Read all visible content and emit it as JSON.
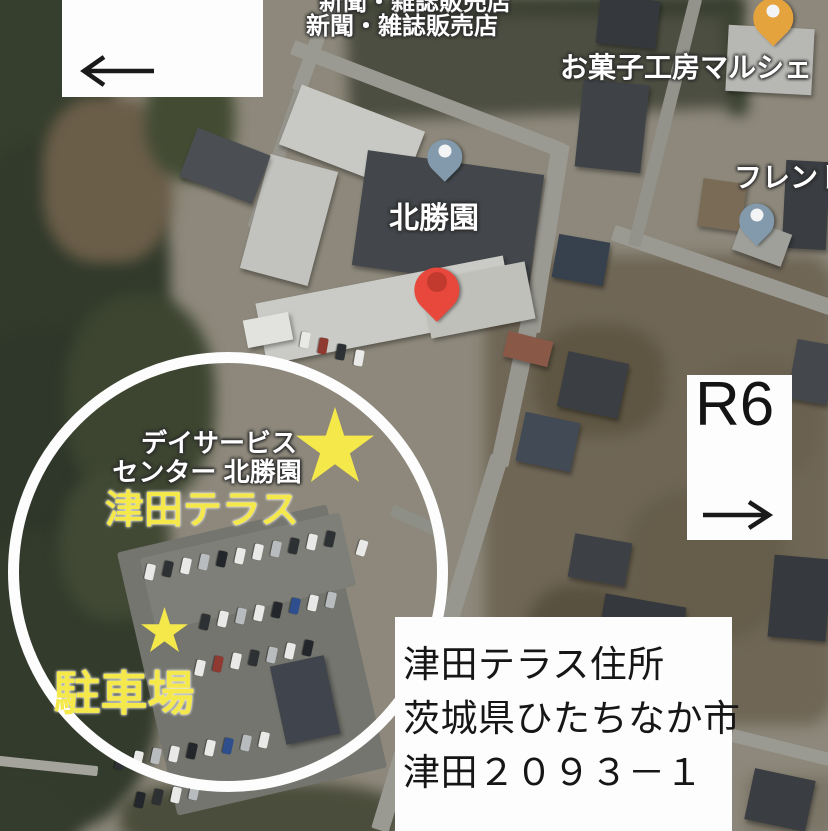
{
  "map_labels": {
    "clipped_top": "新聞・雑誌販売店",
    "newspaper_shop": "新聞・雑誌販売店",
    "sweets_shop": "お菓子工房マルシェ",
    "furento": "フレント",
    "hokushoen": "北勝園",
    "day_service_line1": "デイサービス",
    "day_service_line2": "センター 北勝園"
  },
  "annotations": {
    "tsuda_terrace_label": "津田テラス",
    "parking_label": "駐車場",
    "r6_box": {
      "label": "R6",
      "arrow_direction": "right"
    },
    "top_left_box": {
      "arrow_direction": "left"
    },
    "address_box": {
      "lines": [
        "津田テラス住所",
        "茨城県ひたちなか市",
        "津田２０９３－１"
      ]
    }
  },
  "colors": {
    "yellow": "#f4e84b",
    "circle_white": "#fdfdfd",
    "pin_blue": "#8399ac",
    "pin_red": "#e8483b",
    "pin_red_inner": "#c23a2e",
    "pin_orange": "#e5a33e",
    "pin_dot_white": "#f3f4f5",
    "label_white": "#ffffff",
    "arrow_black": "#1a1a1a",
    "address_text": "#161616"
  },
  "map_features": {
    "base": [
      {
        "n": "ground-base",
        "x": 414,
        "y": 416,
        "w": 832,
        "h": 835,
        "c": "#8d887b"
      }
    ],
    "ground": [
      {
        "n": "scrub-field-right",
        "x": 660,
        "y": 490,
        "w": 350,
        "h": 470,
        "c": "#6f6656",
        "br": "8%"
      },
      {
        "n": "scrub-patch",
        "x": 600,
        "y": 380,
        "w": 130,
        "h": 110,
        "c": "#5e5642",
        "br": "40%"
      },
      {
        "n": "scrub-patch",
        "x": 705,
        "y": 565,
        "w": 160,
        "h": 150,
        "c": "#665e4b",
        "br": "40%"
      },
      {
        "n": "scrub-patch",
        "x": 580,
        "y": 650,
        "w": 110,
        "h": 130,
        "c": "#59513f",
        "br": "40%"
      },
      {
        "n": "scrub-patch",
        "x": 760,
        "y": 420,
        "w": 120,
        "h": 120,
        "c": "#6a6150",
        "br": "40%"
      },
      {
        "n": "ground-bottom-right",
        "x": 790,
        "y": 805,
        "w": 90,
        "h": 60,
        "c": "#7b7567",
        "br": "10%"
      },
      {
        "n": "dark-field",
        "x": 545,
        "y": 58,
        "w": 395,
        "h": 112,
        "rot": -2,
        "c": "#4c4e41"
      },
      {
        "n": "field-hedge",
        "x": 545,
        "y": 6,
        "w": 395,
        "h": 16,
        "c": "#343b2c"
      },
      {
        "n": "field-hedge",
        "x": 735,
        "y": 60,
        "w": 18,
        "h": 110,
        "rot": -4,
        "c": "#3a4130"
      }
    ],
    "forests": [
      {
        "n": "forest",
        "x": 30,
        "y": 80,
        "w": 170,
        "h": 230,
        "c": "#363e2d",
        "br": "45%"
      },
      {
        "n": "forest",
        "x": 60,
        "y": 280,
        "w": 220,
        "h": 280,
        "c": "#323a2b",
        "br": "45%"
      },
      {
        "n": "forest",
        "x": 45,
        "y": 480,
        "w": 200,
        "h": 300,
        "c": "#2f372a",
        "br": "45%"
      },
      {
        "n": "forest",
        "x": 55,
        "y": 680,
        "w": 210,
        "h": 300,
        "c": "#333b2c",
        "br": "45%"
      },
      {
        "n": "forest",
        "x": 140,
        "y": 400,
        "w": 150,
        "h": 210,
        "c": "#3d4531",
        "br": "45%"
      },
      {
        "n": "forest",
        "x": 115,
        "y": 545,
        "w": 110,
        "h": 150,
        "c": "#414935",
        "br": "45%"
      },
      {
        "n": "forest",
        "x": 15,
        "y": 815,
        "w": 130,
        "h": 90,
        "c": "#343c2d",
        "br": "40%"
      },
      {
        "n": "scrub-bottom",
        "x": 260,
        "y": 818,
        "w": 280,
        "h": 70,
        "c": "#4b4d3c",
        "br": "35%"
      },
      {
        "n": "brown-clearing",
        "x": 108,
        "y": 180,
        "w": 130,
        "h": 165,
        "c": "#6b5e49",
        "br": "40%"
      },
      {
        "n": "forest-edge",
        "x": 190,
        "y": 120,
        "w": 90,
        "h": 120,
        "c": "#434b33",
        "br": "45%"
      }
    ],
    "roads": [
      {
        "n": "road",
        "x": 315,
        "y": 46,
        "w": 14,
        "h": 96,
        "rot": 20,
        "c": "#9b9a92"
      },
      {
        "n": "road",
        "x": 277,
        "y": 160,
        "w": 13,
        "h": 145,
        "rot": 19,
        "c": "#96958d"
      },
      {
        "n": "road",
        "x": 428,
        "y": 99,
        "w": 290,
        "h": 15,
        "rot": 21,
        "c": "#9b9a92"
      },
      {
        "n": "road",
        "x": 546,
        "y": 238,
        "w": 18,
        "h": 190,
        "rot": 9,
        "c": "#9b9a92"
      },
      {
        "n": "road",
        "x": 515,
        "y": 392,
        "w": 18,
        "h": 150,
        "rot": 12,
        "c": "#98978f"
      },
      {
        "n": "road",
        "x": 474,
        "y": 540,
        "w": 18,
        "h": 175,
        "rot": 17,
        "c": "#98978f"
      },
      {
        "n": "road",
        "x": 412,
        "y": 725,
        "w": 18,
        "h": 220,
        "rot": 17,
        "c": "#9b9a92"
      },
      {
        "n": "road",
        "x": 722,
        "y": 270,
        "w": 230,
        "h": 16,
        "rot": 19,
        "c": "#9b9a92"
      },
      {
        "n": "road",
        "x": 665,
        "y": 122,
        "w": 13,
        "h": 255,
        "rot": 14,
        "c": "#94938b"
      },
      {
        "n": "road",
        "x": 783,
        "y": 748,
        "w": 105,
        "h": 13,
        "rot": 14,
        "c": "#9b9a92"
      },
      {
        "n": "road",
        "x": 48,
        "y": 766,
        "w": 100,
        "h": 10,
        "rot": 6,
        "c": "#a5a49c"
      },
      {
        "n": "road-entrance",
        "x": 418,
        "y": 522,
        "w": 58,
        "h": 12,
        "rot": 25,
        "c": "#8e8f87"
      }
    ],
    "parking": [
      {
        "n": "parking-lot",
        "x": 252,
        "y": 660,
        "w": 215,
        "h": 270,
        "rot": -13,
        "c": "#74756e"
      },
      {
        "n": "parking-lot-upper",
        "x": 248,
        "y": 572,
        "w": 205,
        "h": 75,
        "rot": -13,
        "c": "#7e7f78"
      }
    ],
    "buildings": [
      {
        "n": "facility-roof",
        "x": 352,
        "y": 138,
        "w": 132,
        "h": 64,
        "rot": 21,
        "c": "#c8c9c4"
      },
      {
        "n": "facility-roof",
        "x": 289,
        "y": 220,
        "w": 70,
        "h": 118,
        "rot": 15,
        "c": "#c2c3be"
      },
      {
        "n": "facility-dark-roof",
        "x": 448,
        "y": 220,
        "w": 178,
        "h": 116,
        "rot": 8,
        "c": "#43474b"
      },
      {
        "n": "facility-roof",
        "x": 385,
        "y": 310,
        "w": 252,
        "h": 62,
        "rot": -11,
        "c": "#cacbc6"
      },
      {
        "n": "facility-roof",
        "x": 478,
        "y": 300,
        "w": 106,
        "h": 58,
        "rot": -11,
        "c": "#bfc0ba"
      },
      {
        "n": "small-building",
        "x": 268,
        "y": 330,
        "w": 46,
        "h": 28,
        "rot": -11,
        "c": "#e2e3df"
      },
      {
        "n": "house",
        "x": 225,
        "y": 166,
        "w": 78,
        "h": 52,
        "rot": 21,
        "c": "#4b4f53"
      },
      {
        "n": "house",
        "x": 612,
        "y": 126,
        "w": 66,
        "h": 88,
        "rot": 6,
        "c": "#3f4347"
      },
      {
        "n": "house",
        "x": 628,
        "y": 22,
        "w": 60,
        "h": 48,
        "rot": 6,
        "c": "#35383c"
      },
      {
        "n": "shop-roof",
        "x": 770,
        "y": 60,
        "w": 86,
        "h": 66,
        "rot": 3,
        "c": "#b7b8b3"
      },
      {
        "n": "house",
        "x": 806,
        "y": 205,
        "w": 44,
        "h": 88,
        "rot": 3,
        "c": "#3a3d41"
      },
      {
        "n": "shed",
        "x": 722,
        "y": 205,
        "w": 44,
        "h": 48,
        "rot": 8,
        "c": "#7a6b56"
      },
      {
        "n": "house-solar",
        "x": 581,
        "y": 260,
        "w": 52,
        "h": 44,
        "rot": 10,
        "c": "#37414e"
      },
      {
        "n": "house-red-roof",
        "x": 528,
        "y": 349,
        "w": 46,
        "h": 26,
        "rot": 14,
        "c": "#8a5847"
      },
      {
        "n": "house",
        "x": 593,
        "y": 385,
        "w": 62,
        "h": 56,
        "rot": 12,
        "c": "#3b3e42"
      },
      {
        "n": "house-solar",
        "x": 548,
        "y": 442,
        "w": 56,
        "h": 50,
        "rot": 12,
        "c": "#414a55"
      },
      {
        "n": "house",
        "x": 640,
        "y": 635,
        "w": 82,
        "h": 70,
        "rot": 10,
        "c": "#35383c"
      },
      {
        "n": "house",
        "x": 672,
        "y": 742,
        "w": 84,
        "h": 72,
        "rot": 10,
        "c": "#3b3f43"
      },
      {
        "n": "house",
        "x": 800,
        "y": 598,
        "w": 58,
        "h": 82,
        "rot": 5,
        "c": "#36393d"
      },
      {
        "n": "house",
        "x": 780,
        "y": 800,
        "w": 62,
        "h": 52,
        "rot": 12,
        "c": "#3a3d41"
      },
      {
        "n": "house",
        "x": 762,
        "y": 242,
        "w": 52,
        "h": 34,
        "rot": 20,
        "c": "#9fa09a"
      },
      {
        "n": "house",
        "x": 812,
        "y": 372,
        "w": 40,
        "h": 60,
        "rot": 10,
        "c": "#44484c"
      },
      {
        "n": "house",
        "x": 600,
        "y": 560,
        "w": 58,
        "h": 44,
        "rot": 10,
        "c": "#3d4145"
      },
      {
        "n": "house",
        "x": 305,
        "y": 700,
        "w": 55,
        "h": 80,
        "rot": -12,
        "c": "#40444c"
      }
    ],
    "cars": [
      {
        "x": 150,
        "y": 572,
        "rot": 102,
        "c": "#e9eae8"
      },
      {
        "x": 168,
        "y": 569,
        "rot": 102,
        "c": "#2e3134"
      },
      {
        "x": 186,
        "y": 566,
        "rot": 102,
        "c": "#e9eae8"
      },
      {
        "x": 204,
        "y": 562,
        "rot": 102,
        "c": "#b9bcbe"
      },
      {
        "x": 222,
        "y": 559,
        "rot": 102,
        "c": "#23262a"
      },
      {
        "x": 240,
        "y": 556,
        "rot": 102,
        "c": "#e9eae8"
      },
      {
        "x": 258,
        "y": 552,
        "rot": 102,
        "c": "#e9eae8"
      },
      {
        "x": 276,
        "y": 549,
        "rot": 102,
        "c": "#b9bcbe"
      },
      {
        "x": 294,
        "y": 546,
        "rot": 102,
        "c": "#2e3134"
      },
      {
        "x": 312,
        "y": 542,
        "rot": 102,
        "c": "#e9eae8"
      },
      {
        "x": 330,
        "y": 539,
        "rot": 102,
        "c": "#2e3134"
      },
      {
        "x": 205,
        "y": 622,
        "rot": 102,
        "c": "#2e3134"
      },
      {
        "x": 223,
        "y": 619,
        "rot": 102,
        "c": "#e9eae8"
      },
      {
        "x": 241,
        "y": 616,
        "rot": 102,
        "c": "#b9bcbe"
      },
      {
        "x": 259,
        "y": 613,
        "rot": 102,
        "c": "#e9eae8"
      },
      {
        "x": 277,
        "y": 610,
        "rot": 102,
        "c": "#23262a"
      },
      {
        "x": 295,
        "y": 606,
        "rot": 102,
        "c": "#2f4e8d"
      },
      {
        "x": 313,
        "y": 603,
        "rot": 102,
        "c": "#e9eae8"
      },
      {
        "x": 331,
        "y": 600,
        "rot": 102,
        "c": "#b9bcbe"
      },
      {
        "x": 200,
        "y": 668,
        "rot": 102,
        "c": "#e9eae8"
      },
      {
        "x": 218,
        "y": 664,
        "rot": 102,
        "c": "#8e3a31"
      },
      {
        "x": 236,
        "y": 661,
        "rot": 102,
        "c": "#e9eae8"
      },
      {
        "x": 254,
        "y": 658,
        "rot": 102,
        "c": "#2e3134"
      },
      {
        "x": 272,
        "y": 655,
        "rot": 102,
        "c": "#b9bcbe"
      },
      {
        "x": 290,
        "y": 651,
        "rot": 102,
        "c": "#e9eae8"
      },
      {
        "x": 308,
        "y": 648,
        "rot": 102,
        "c": "#23262a"
      },
      {
        "x": 120,
        "y": 762,
        "rot": 102,
        "c": "#2e3134"
      },
      {
        "x": 138,
        "y": 759,
        "rot": 102,
        "c": "#e9eae8"
      },
      {
        "x": 156,
        "y": 756,
        "rot": 102,
        "c": "#b9bcbe"
      },
      {
        "x": 174,
        "y": 754,
        "rot": 102,
        "c": "#e9eae8"
      },
      {
        "x": 192,
        "y": 751,
        "rot": 102,
        "c": "#23262a"
      },
      {
        "x": 210,
        "y": 748,
        "rot": 102,
        "c": "#e9eae8"
      },
      {
        "x": 228,
        "y": 746,
        "rot": 102,
        "c": "#2f4e8d"
      },
      {
        "x": 246,
        "y": 743,
        "rot": 102,
        "c": "#b9bcbe"
      },
      {
        "x": 264,
        "y": 740,
        "rot": 102,
        "c": "#e9eae8"
      },
      {
        "x": 140,
        "y": 800,
        "rot": 102,
        "c": "#23262a"
      },
      {
        "x": 158,
        "y": 797,
        "rot": 102,
        "c": "#2e3134"
      },
      {
        "x": 176,
        "y": 795,
        "rot": 102,
        "c": "#e9eae8"
      },
      {
        "x": 194,
        "y": 792,
        "rot": 102,
        "c": "#b9bcbe"
      },
      {
        "x": 362,
        "y": 548,
        "rot": 107,
        "c": "#e9eae8"
      },
      {
        "x": 305,
        "y": 340,
        "rot": 100,
        "c": "#e9eae8"
      },
      {
        "x": 323,
        "y": 346,
        "rot": 100,
        "c": "#8e3a31"
      },
      {
        "x": 341,
        "y": 352,
        "rot": 100,
        "c": "#2e3134"
      },
      {
        "x": 359,
        "y": 358,
        "rot": 100,
        "c": "#e9eae8"
      }
    ]
  }
}
